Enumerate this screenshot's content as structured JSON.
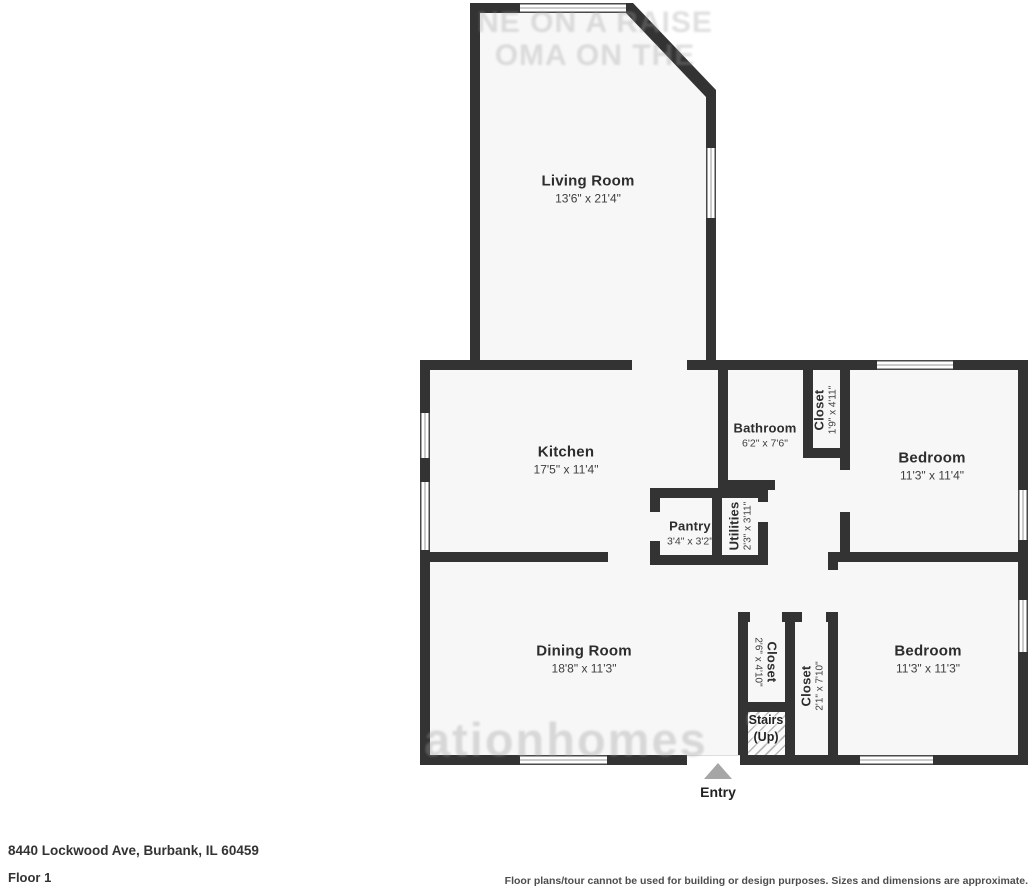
{
  "address": "8440 Lockwood Ave, Burbank, IL 60459",
  "floor": "Floor 1",
  "disclaimer": "Floor plans/tour cannot be used for building or design purposes. Sizes and dimensions are approximate.",
  "entry": "Entry",
  "colors": {
    "wall": "#333333",
    "room_fill": "#f7f7f7",
    "entry_arrow": "#a6a6a6"
  },
  "watermarks": {
    "top_line_1": "NE ON A RAISE",
    "top_line_2": "OMA ON THE",
    "bottom": "ationhomes"
  },
  "rooms": {
    "living": {
      "name": "Living Room",
      "dims": "13'6\" x 21'4\""
    },
    "kitchen": {
      "name": "Kitchen",
      "dims": "17'5\" x 11'4\""
    },
    "bathroom": {
      "name": "Bathroom",
      "dims": "6'2\" x 7'6\""
    },
    "closet_hall": {
      "name": "Closet",
      "dims": "1'9\" x 4'11\""
    },
    "bedroom1": {
      "name": "Bedroom",
      "dims": "11'3\" x 11'4\""
    },
    "pantry": {
      "name": "Pantry",
      "dims": "3'4\" x 3'2\""
    },
    "utilities": {
      "name": "Utilities",
      "dims": "2'3\" x 3'11\""
    },
    "dining": {
      "name": "Dining Room",
      "dims": "18'8\" x 11'3\""
    },
    "closet_a": {
      "name": "Closet",
      "dims": "2'6\" x 4'10\""
    },
    "closet_b": {
      "name": "Closet",
      "dims": "2'1\" x 7'10\""
    },
    "bedroom2": {
      "name": "Bedroom",
      "dims": "11'3\" x 11'3\""
    },
    "stairs": {
      "name": "Stairs",
      "sub": "(Up)"
    }
  }
}
